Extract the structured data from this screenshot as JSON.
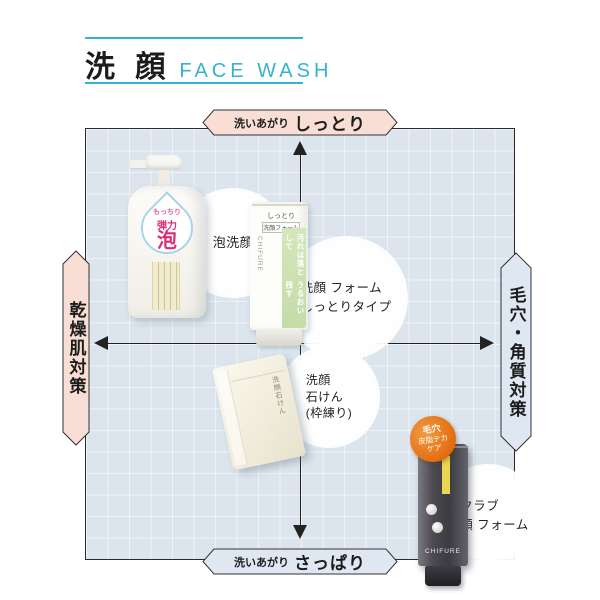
{
  "header": {
    "title_jp": "洗 顔",
    "title_en": "FACE WASH"
  },
  "matrix": {
    "top": {
      "prefix": "洗いあがり",
      "label": "しっとり"
    },
    "bottom": {
      "prefix": "洗いあがり",
      "label": "さっぱり"
    },
    "left": {
      "label": "乾燥肌対策"
    },
    "right": {
      "label": "毛穴・角質対策"
    }
  },
  "products": {
    "foam": {
      "note": "泡洗顔",
      "drop_top": "もっちり",
      "drop_mid": "弾力",
      "drop_big": "泡"
    },
    "moist": {
      "note1": "洗顔 フォーム",
      "note2": "しっとりタイプ",
      "top1": "しっとり",
      "top2": "洗顔フォーム",
      "copy1": "汚れは落として",
      "copy2": "うるおい残す",
      "brand": "CHIFURE"
    },
    "soap": {
      "note1": "洗顔",
      "note2": "石けん",
      "note3": "(枠練り)",
      "pkg": "洗顔石けん"
    },
    "scrub": {
      "note1": "スクラブ",
      "note2": "洗顔 フォーム",
      "badge1": "毛穴",
      "badge2": "皮脂テカ",
      "badge3": "ケア",
      "brand": "CHIFURE"
    }
  },
  "colors": {
    "accent_teal": "#35b4cb",
    "moist_pink": "#f8ded4",
    "fresh_blue": "#dfe8f2",
    "chart_bg": "#dce5ed",
    "axis_black": "#222222",
    "foam_label_pink": "#d82e74",
    "tube_green": "#cfe2b5",
    "scrub_badge_orange": "#e2690d"
  }
}
